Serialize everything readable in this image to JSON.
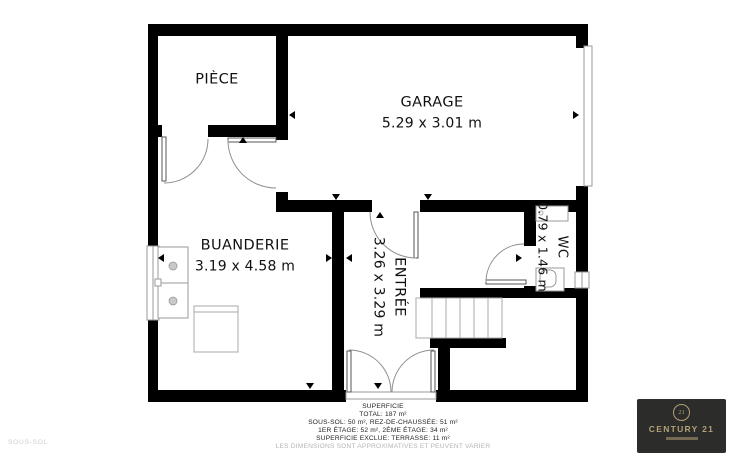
{
  "floor_label": "SOUS-SOL",
  "rooms": {
    "piece": {
      "name": "PIÈCE"
    },
    "garage": {
      "name": "GARAGE",
      "dims": "5.29 x 3.01 m"
    },
    "buanderie": {
      "name": "BUANDERIE",
      "dims": "3.19 x 4.58 m"
    },
    "entree": {
      "name": "ENTRÉE",
      "dims": "3.26 x 3.29 m"
    },
    "wc": {
      "name": "WC",
      "dims": "0.79 x 1.46 m"
    }
  },
  "footer": {
    "title": "SUPERFICIE",
    "total": "TOTAL: 187 m²",
    "line1": "SOUS-SOL: 50 m², REZ-DE-CHAUSSÉE: 51 m²",
    "line2": "1ER ÉTAGE: 52 m², 2ÈME ÉTAGE: 34 m²",
    "line3": "SUPERFICIE EXCLUE: TERRASSE: 11 m²",
    "disclaimer": "LES DIMENSIONS SONT APPROXIMATIVES ET PEUVENT VARIER"
  },
  "logo": {
    "brand": "CENTURY 21",
    "seal": "21"
  },
  "colors": {
    "wall": "#000000",
    "fixture_line": "#9a9a9a",
    "door_arc": "#8f8f8f",
    "logo_bg": "#2c2c2a",
    "logo_gold": "#b3a078",
    "muted_text": "#cccccc"
  }
}
